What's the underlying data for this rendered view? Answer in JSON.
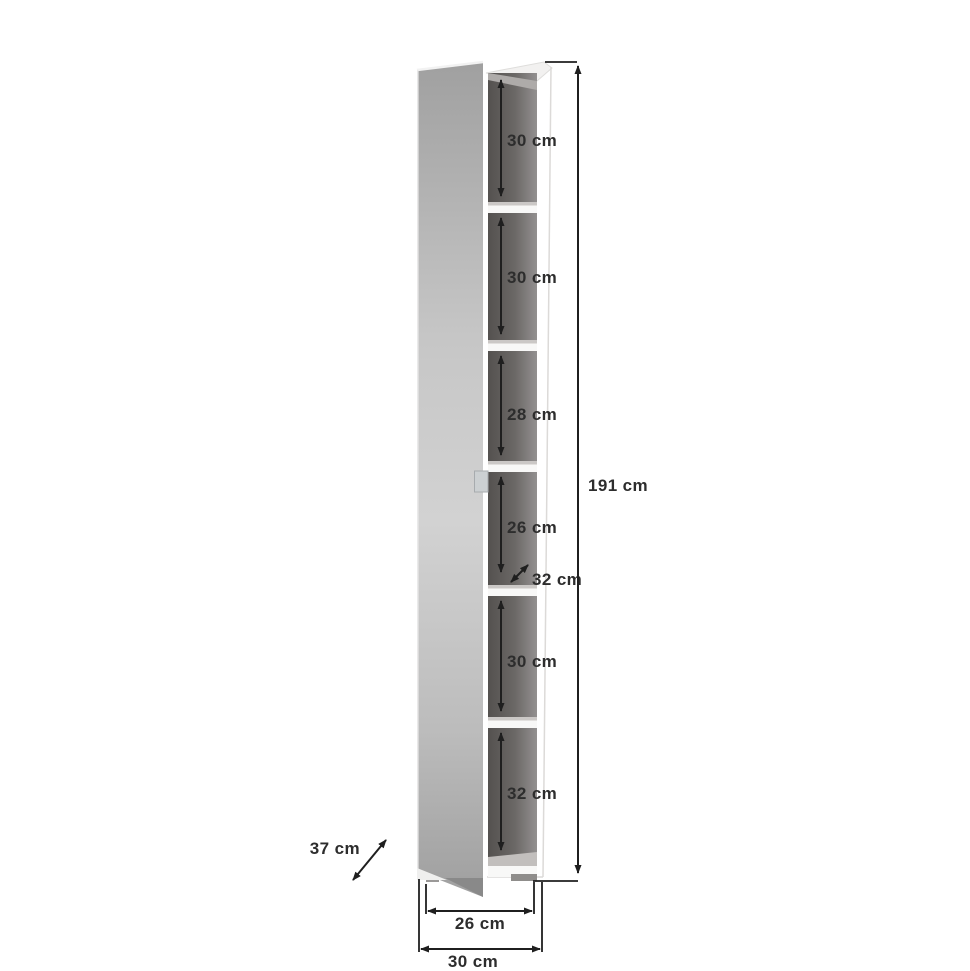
{
  "diagram": {
    "kind": "furniture-dimension-diagram",
    "subject": "tall narrow cabinet with open mirror door and six shelf compartments",
    "unit": "cm",
    "total_height": {
      "value": 191,
      "label": "191 cm"
    },
    "total_width": {
      "value": 30,
      "label": "30 cm"
    },
    "feet_span_width": {
      "value": 26,
      "label": "26 cm"
    },
    "total_depth": {
      "value": 37,
      "label": "37 cm"
    },
    "shelf_depth": {
      "value": 32,
      "label": "32 cm"
    },
    "compartments": [
      {
        "index": 1,
        "height_cm": 30,
        "label": "30 cm"
      },
      {
        "index": 2,
        "height_cm": 30,
        "label": "30 cm"
      },
      {
        "index": 3,
        "height_cm": 28,
        "label": "28 cm"
      },
      {
        "index": 4,
        "height_cm": 26,
        "label": "26 cm"
      },
      {
        "index": 5,
        "height_cm": 30,
        "label": "30 cm"
      },
      {
        "index": 6,
        "height_cm": 32,
        "label": "32 cm"
      }
    ]
  },
  "colors": {
    "background": "#ffffff",
    "line": "#1f1f1f",
    "text": "#2d2d2d",
    "interior_dark": "#54514f",
    "interior_light": "#939090",
    "shelf_white": "#f8f8f7",
    "door_gray_top": "#a0a0a0",
    "door_gray_light": "#d2d2d2",
    "foot_gray": "#8f8d8b"
  }
}
